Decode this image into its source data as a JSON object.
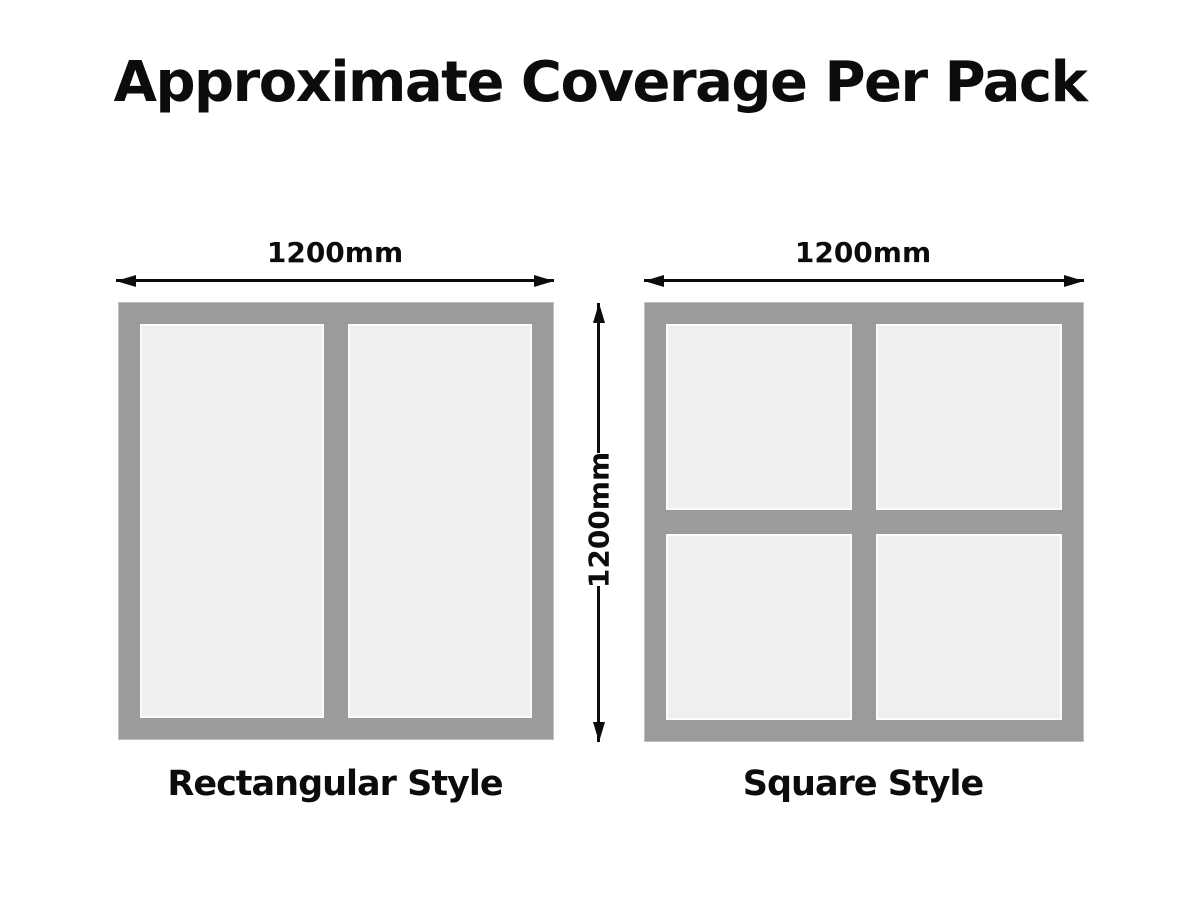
{
  "title": "Approximate Coverage Per Pack",
  "left_diagram": {
    "caption": "Rectangular Style",
    "width_label": "1200mm",
    "panel_count": 2,
    "layout": "1 row x 2 columns"
  },
  "right_diagram": {
    "caption": "Square Style",
    "width_label": "1200mm",
    "panel_count": 4,
    "layout": "2 rows x 2 columns"
  },
  "shared_height_label": "1200mm",
  "colors": {
    "frame_gray": "#9b9b9b",
    "panel_fill": "#efefef",
    "panel_border": "#fbfbfb",
    "text": "#0c0c0c",
    "background": "#ffffff"
  }
}
